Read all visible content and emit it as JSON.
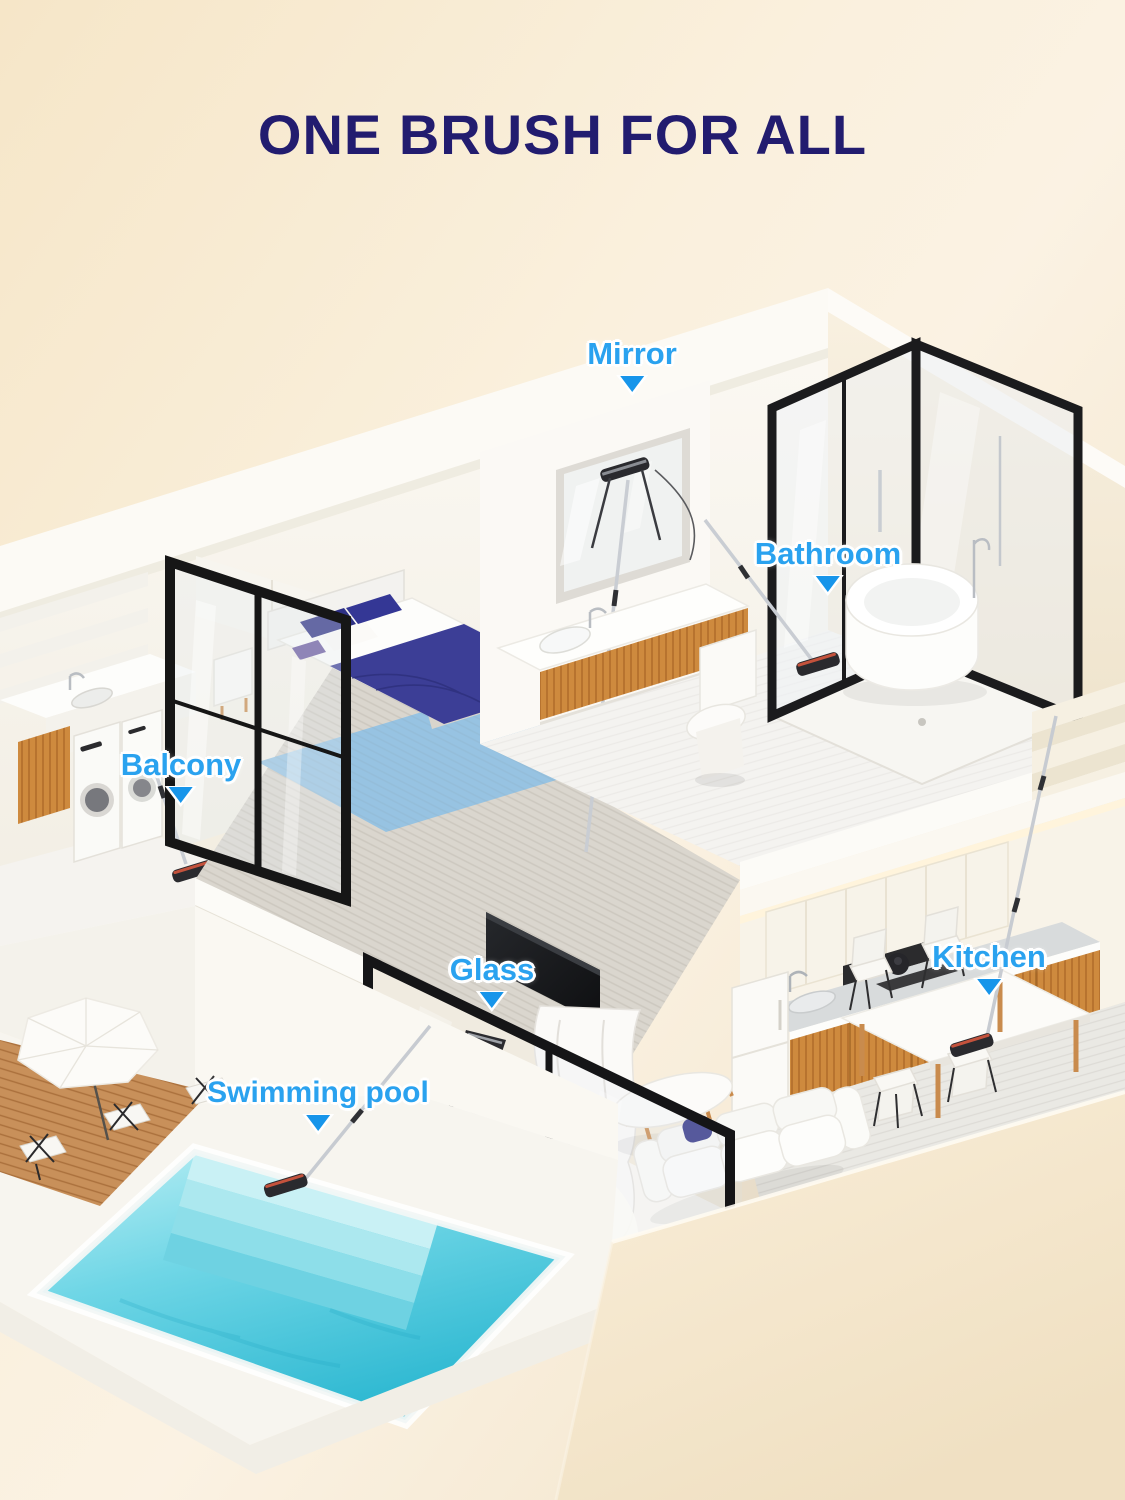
{
  "title": "ONE BRUSH FOR ALL",
  "annotations": [
    {
      "id": "mirror",
      "text": "Mirror"
    },
    {
      "id": "bathroom",
      "text": "Bathroom"
    },
    {
      "id": "balcony",
      "text": "Balcony"
    },
    {
      "id": "glass",
      "text": "Glass"
    },
    {
      "id": "kitchen",
      "text": "Kitchen"
    },
    {
      "id": "swimming-pool",
      "text": "Swimming pool"
    }
  ],
  "colors": {
    "title_navy": "#221C6F",
    "label_blue": "#2AA2EF",
    "pointer_blue": "#1795EA",
    "background_cream": "#F6E9CF",
    "pool_water": "#55CADF",
    "wood_accent": "#CE8A3E",
    "frame_black": "#1A1A1C"
  },
  "scene": {
    "description": "Isometric cutaway of a two-story home; the same cleaning brush appears in six spots",
    "locations_shown": [
      "bathroom mirror",
      "bathroom floor",
      "balcony laundry floor",
      "living-room glass wall",
      "kitchen floor",
      "swimming-pool deck"
    ]
  }
}
